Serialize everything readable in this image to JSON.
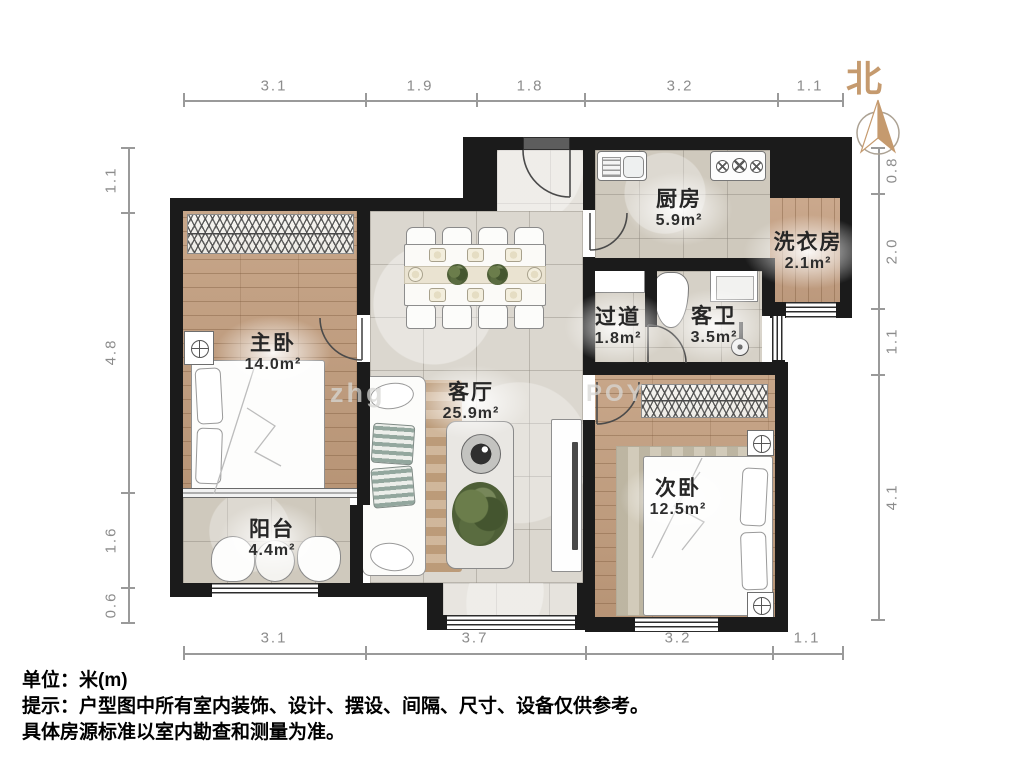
{
  "compass": {
    "north_label": "北"
  },
  "rooms": [
    {
      "id": "master-bedroom",
      "name": "主卧",
      "area": "14.0m²",
      "cx": 273,
      "cy": 353
    },
    {
      "id": "balcony",
      "name": "阳台",
      "area": "4.4m²",
      "cx": 272,
      "cy": 539
    },
    {
      "id": "living-room",
      "name": "客厅",
      "area": "25.9m²",
      "cx": 471,
      "cy": 402
    },
    {
      "id": "kitchen",
      "name": "厨房",
      "area": "5.9m²",
      "cx": 679,
      "cy": 209
    },
    {
      "id": "laundry-room",
      "name": "洗衣房",
      "area": "2.1m²",
      "cx": 808,
      "cy": 252
    },
    {
      "id": "hallway",
      "name": "过道",
      "area": "1.8m²",
      "cx": 618,
      "cy": 327
    },
    {
      "id": "guest-bathroom",
      "name": "客卫",
      "area": "3.5m²",
      "cx": 714,
      "cy": 326
    },
    {
      "id": "second-bedroom",
      "name": "次卧",
      "area": "12.5m²",
      "cx": 678,
      "cy": 498
    }
  ],
  "dimensions": {
    "top": [
      {
        "v": "3.1",
        "x": 274
      },
      {
        "v": "1.9",
        "x": 420
      },
      {
        "v": "1.8",
        "x": 530
      },
      {
        "v": "3.2",
        "x": 680
      },
      {
        "v": "1.1",
        "x": 810
      }
    ],
    "bottom": [
      {
        "v": "3.1",
        "x": 274
      },
      {
        "v": "3.7",
        "x": 475
      },
      {
        "v": "3.2",
        "x": 678
      },
      {
        "v": "1.1",
        "x": 807
      }
    ],
    "left": [
      {
        "v": "1.1",
        "y": 180
      },
      {
        "v": "4.8",
        "y": 352
      },
      {
        "v": "1.6",
        "y": 540
      },
      {
        "v": "0.6",
        "y": 605
      }
    ],
    "right": [
      {
        "v": "0.8",
        "y": 170
      },
      {
        "v": "2.0",
        "y": 251
      },
      {
        "v": "1.1",
        "y": 341
      },
      {
        "v": "4.1",
        "y": 497
      }
    ]
  },
  "notes": [
    "单位：米(m)",
    "提示：户型图中所有室内装饰、设计、摆设、间隔、尺寸、设备仅供参考。",
    "具体房源标准以室内勘查和测量为准。"
  ],
  "watermarks": [
    {
      "text": "zhg",
      "x": 330,
      "y": 378,
      "size": 27
    },
    {
      "text": "POY",
      "x": 586,
      "y": 380,
      "size": 24
    }
  ],
  "colors": {
    "wall": "#1b1b1b",
    "wood": "#c19c7c",
    "tile": "#dbd7cf",
    "north_accent": "#c59a6e",
    "dim_text": "#8c8c8c"
  }
}
